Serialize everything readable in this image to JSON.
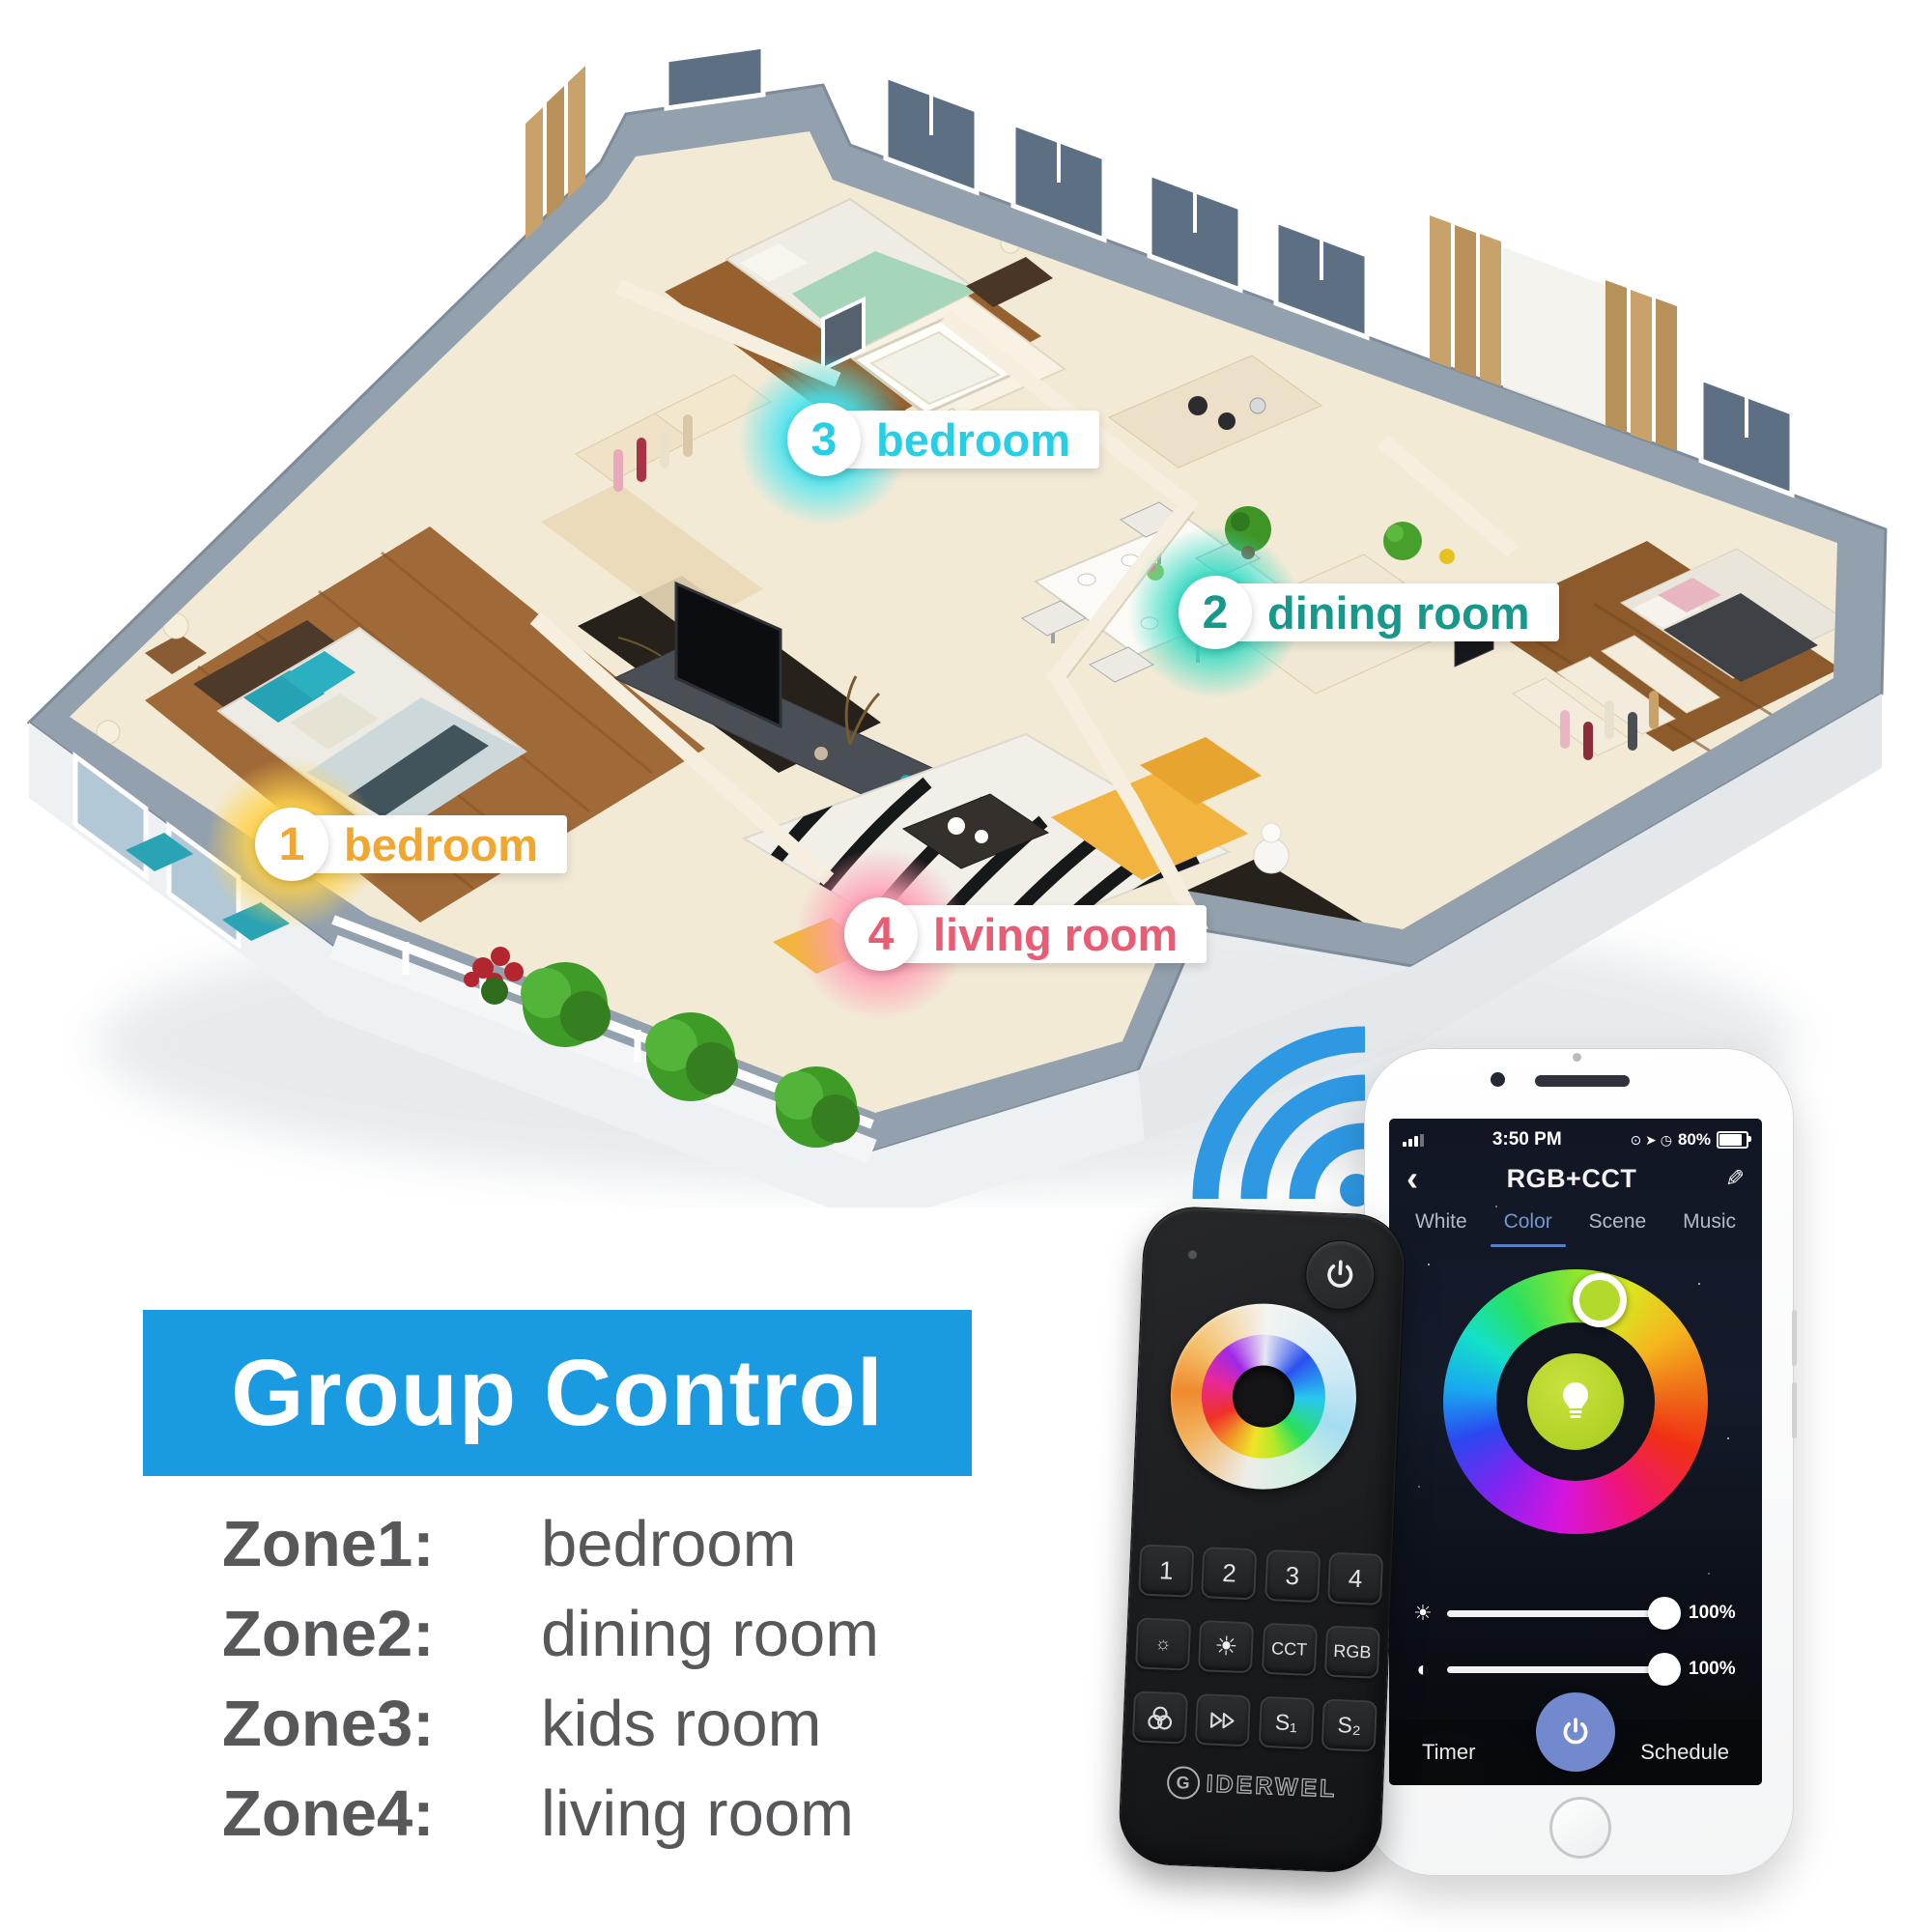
{
  "floorplan": {
    "labels": [
      {
        "num": "1",
        "name": "bedroom",
        "color": "#f0a62f",
        "glow": "#ffd34d"
      },
      {
        "num": "2",
        "name": "dining room",
        "color": "#17988a",
        "glow": "#35dcc4"
      },
      {
        "num": "3",
        "name": "bedroom",
        "color": "#27cfe6",
        "glow": "#45e6f2"
      },
      {
        "num": "4",
        "name": "living room",
        "color": "#e85c74",
        "glow": "#ff9db4"
      }
    ]
  },
  "banner": {
    "title": "Group Control",
    "bg": "#1a9ae1"
  },
  "zone_list": [
    {
      "zone": "Zone1:",
      "room": "bedroom"
    },
    {
      "zone": "Zone2:",
      "room": "dining room"
    },
    {
      "zone": "Zone3:",
      "room": "kids room"
    },
    {
      "zone": "Zone4:",
      "room": "living room"
    }
  ],
  "remote": {
    "brand_g": "G",
    "brand_rest": "IDERWEL",
    "zone_buttons": [
      "1",
      "2",
      "3",
      "4"
    ],
    "dim_icon": "☼",
    "bright_icon": "☀",
    "cct_label": "CCT",
    "rgb_label": "RGB",
    "s1_label": "S₁",
    "s2_label": "S₂"
  },
  "phone": {
    "status_time": "3:50 PM",
    "status_icons": "⊙ ➤ ◷",
    "battery_pct": "80%",
    "back": "‹",
    "title": "RGB+CCT",
    "edit": "✎",
    "tabs": [
      {
        "label": "White"
      },
      {
        "label": "Color"
      },
      {
        "label": "Scene"
      },
      {
        "label": "Music"
      }
    ],
    "brightness_icon": "☀",
    "saturation_icon": "◐",
    "brightness_value": "100%",
    "saturation_value": "100%",
    "timer_label": "Timer",
    "schedule_label": "Schedule"
  }
}
